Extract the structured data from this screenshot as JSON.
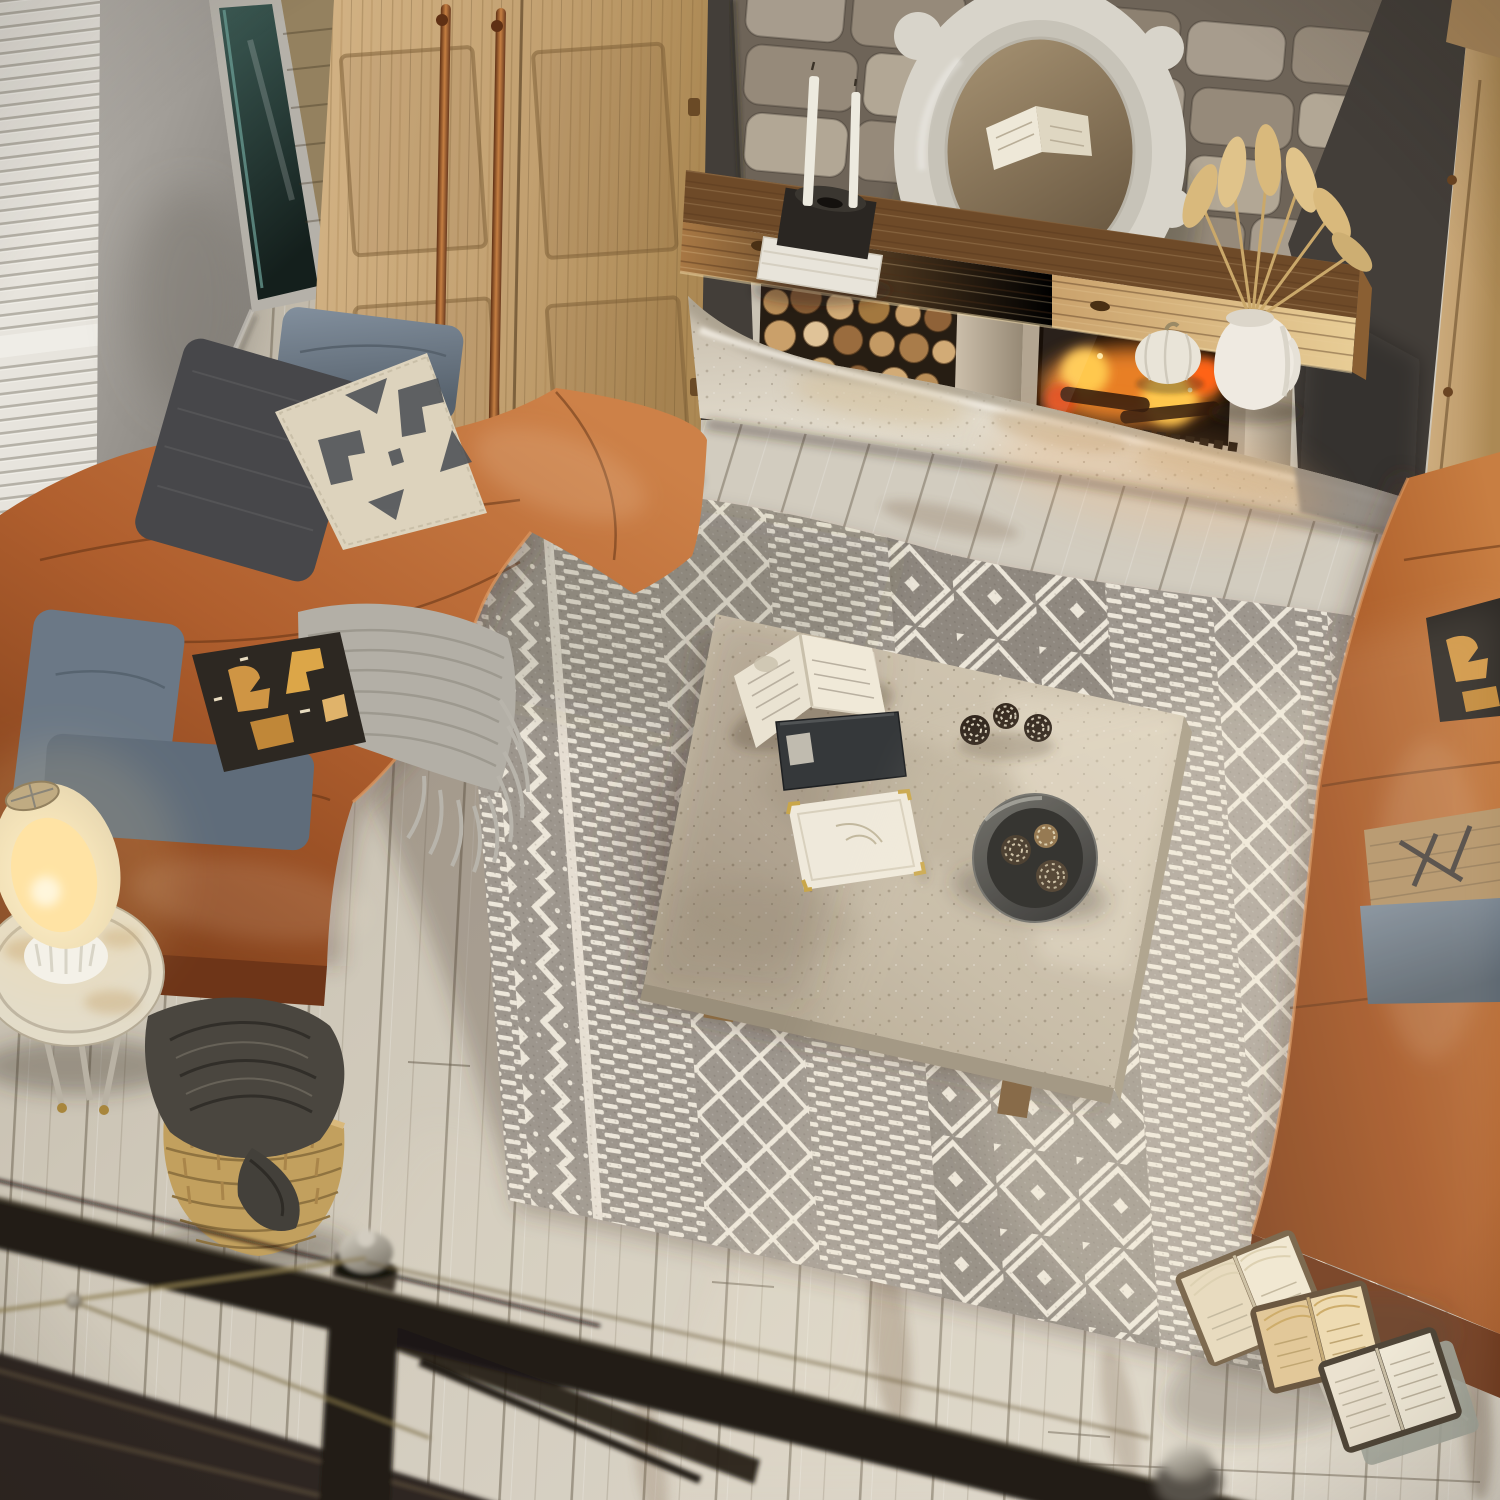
{
  "scene": {
    "title": "Top-down loft view of a rustic living room: stone fireplace with lit firebox and rustic beam mantel, two cognac leather sofas with boho pillows, a gray-and-cream Moroccan diamond rug over whitewashed plank flooring, a travertine coffee table with books and a bowl of pinecones, a lit lamp on a distressed side table, a jute basket with a charcoal blanket, open books on the floor, and a blurred dark metal railing in the foreground",
    "view": "overhead bird's-eye from a loft behind a metal railing",
    "style": "photorealistic interior render",
    "lighting": "warm fireplace glow and soft daylight from the left window"
  },
  "room": {
    "floor": "whitewashed distressed wood planks",
    "walls": [
      "gray plaster wall with white louvered shutters",
      "dark charcoal accent wall",
      "beige fieldstone chimney breast"
    ]
  },
  "objects": {
    "fireplace": {
      "mantel_beam": "weathered rustic timber beam",
      "mirror": "white baroque carved mirror reflecting an open book",
      "candles": "two white taper candles on a black stand over white books",
      "vase": "white pitcher with dried pampas grass",
      "pumpkin": "small white pumpkin",
      "firewood": "cut log ends stacked in a niche",
      "firebox": "glass-front insert with burning logs",
      "hearth": "rough-hewn stone slab"
    },
    "wardrobe": {
      "material": "light oak, two paneled doors",
      "handles": "long copper pulls"
    },
    "right_cabinet": "light oak cabinet with crown molding",
    "sofas": {
      "left": {
        "upholstery": "cognac leather",
        "pillows": [
          "blue-gray chambray",
          "charcoal tweed",
          "cream tribal cross-stitch",
          "black and amber kilim",
          "second blue-gray pair"
        ],
        "throw": "gray fringed knit"
      },
      "right": {
        "upholstery": "cognac leather",
        "pillows": [
          "black and tan kilim",
          "printed burlap",
          "blue-gray chambray"
        ]
      }
    },
    "rug": {
      "style": "Moroccan boho bands",
      "colors": [
        "heather gray",
        "cream"
      ],
      "bands": [
        "zigzag chevron edge",
        "dash stripes",
        "diamond lattice",
        "dash stripes",
        "center diamond trellis",
        "dash stripes",
        "diamond lattice",
        "zigzag chevron edge"
      ],
      "fringe": "along lower-right edge"
    },
    "coffee_table": {
      "material": "travertine concrete top on wood legs",
      "items": [
        "open paperback book",
        "black hardcover book",
        "white keepsake box with brass corners and dried sprig",
        "three frosted pinecones",
        "dark stone bowl holding pinecones"
      ]
    },
    "side_table": {
      "type": "round distressed white accent table",
      "lamp": "lit cream table lamp with fluted white ceramic base"
    },
    "basket": {
      "type": "woven jute belly basket",
      "contents": "charcoal knit blanket draped over the rim"
    },
    "floor_books": "three open books fanned on the floor beside the rug corner",
    "railing": "dark metal loft railing with newel caps and thin brass wires, out of focus in the foreground"
  },
  "palette": {
    "floorBase": "#cfc8b9",
    "floorDark": "#b5ac9b",
    "plankLine": "#8e8270",
    "floorDistress": "#8a7057",
    "wallPlaster": "#a9a5a0",
    "wallDark": "#433e39",
    "shutterWhite": "#e7e4dd",
    "glassTeal": "#30504b",
    "sidingWood": "#93805f",
    "woodLight": "#c9a977",
    "copper": "#8a4f28",
    "stoneMortar": "#6e6458",
    "stoneA": "#a79c8d",
    "stoneB": "#968a7a",
    "stoneC": "#b2a795",
    "stoneD": "#8d8171",
    "beamTop": "#6e4a28",
    "beamFront": "#bf9159",
    "firewoodBg": "#261d13",
    "logA": "#d2ab76",
    "logB": "#a97c4a",
    "logC": "#8a5f36",
    "logD": "#e0c398",
    "insertFrame": "#b3a591",
    "fireGlow": "#ff8c2a",
    "fireHot": "#ffc84d",
    "fireRed": "#e04a12",
    "fireDark": "#180f08",
    "hearthFront": "#ddd4c4",
    "hearthStain": "#d3bd94",
    "hearthDark": "#8e8880",
    "mirrorWhite": "#d8d4ca",
    "vaseWhite": "#efeae1",
    "pampas": "#d9b97c",
    "pumpkin": "#e9e4d8",
    "candleBlack": "#2a2622",
    "candleWhite": "#edeadf",
    "leather": "#b05f2e",
    "leatherHi": "#cd8148",
    "leatherLo": "#7c3d1a",
    "leatherDeep": "#6e3518",
    "rugGray": "#9d968d",
    "rugGrayDeep": "#8f887f",
    "rugCream": "#ece6d9",
    "throwGray": "#b3afa6",
    "pillowBlue": "#76828f",
    "pillowCharcoal": "#47474a",
    "pillowCream": "#ddd3bd",
    "motifSlate": "#4d5156",
    "kilimBlack": "#2d2822",
    "kilimGold": "#cf9544",
    "burlap": "#b29267",
    "concrete": "#c3b8a4",
    "bowlDark": "#3c3c3a",
    "lampShade": "#ecdfc4",
    "lampGlow": "#ffe3a2",
    "tableWhite": "#e0d8c4",
    "basket": "#c2a05e",
    "blanketDark": "#4a463f",
    "pageCream": "#f0e9d8",
    "pageTan": "#dfc392",
    "railDark": "#221d17",
    "brass": "#8a7a4e",
    "metalCap": "#c6c0b2"
  }
}
